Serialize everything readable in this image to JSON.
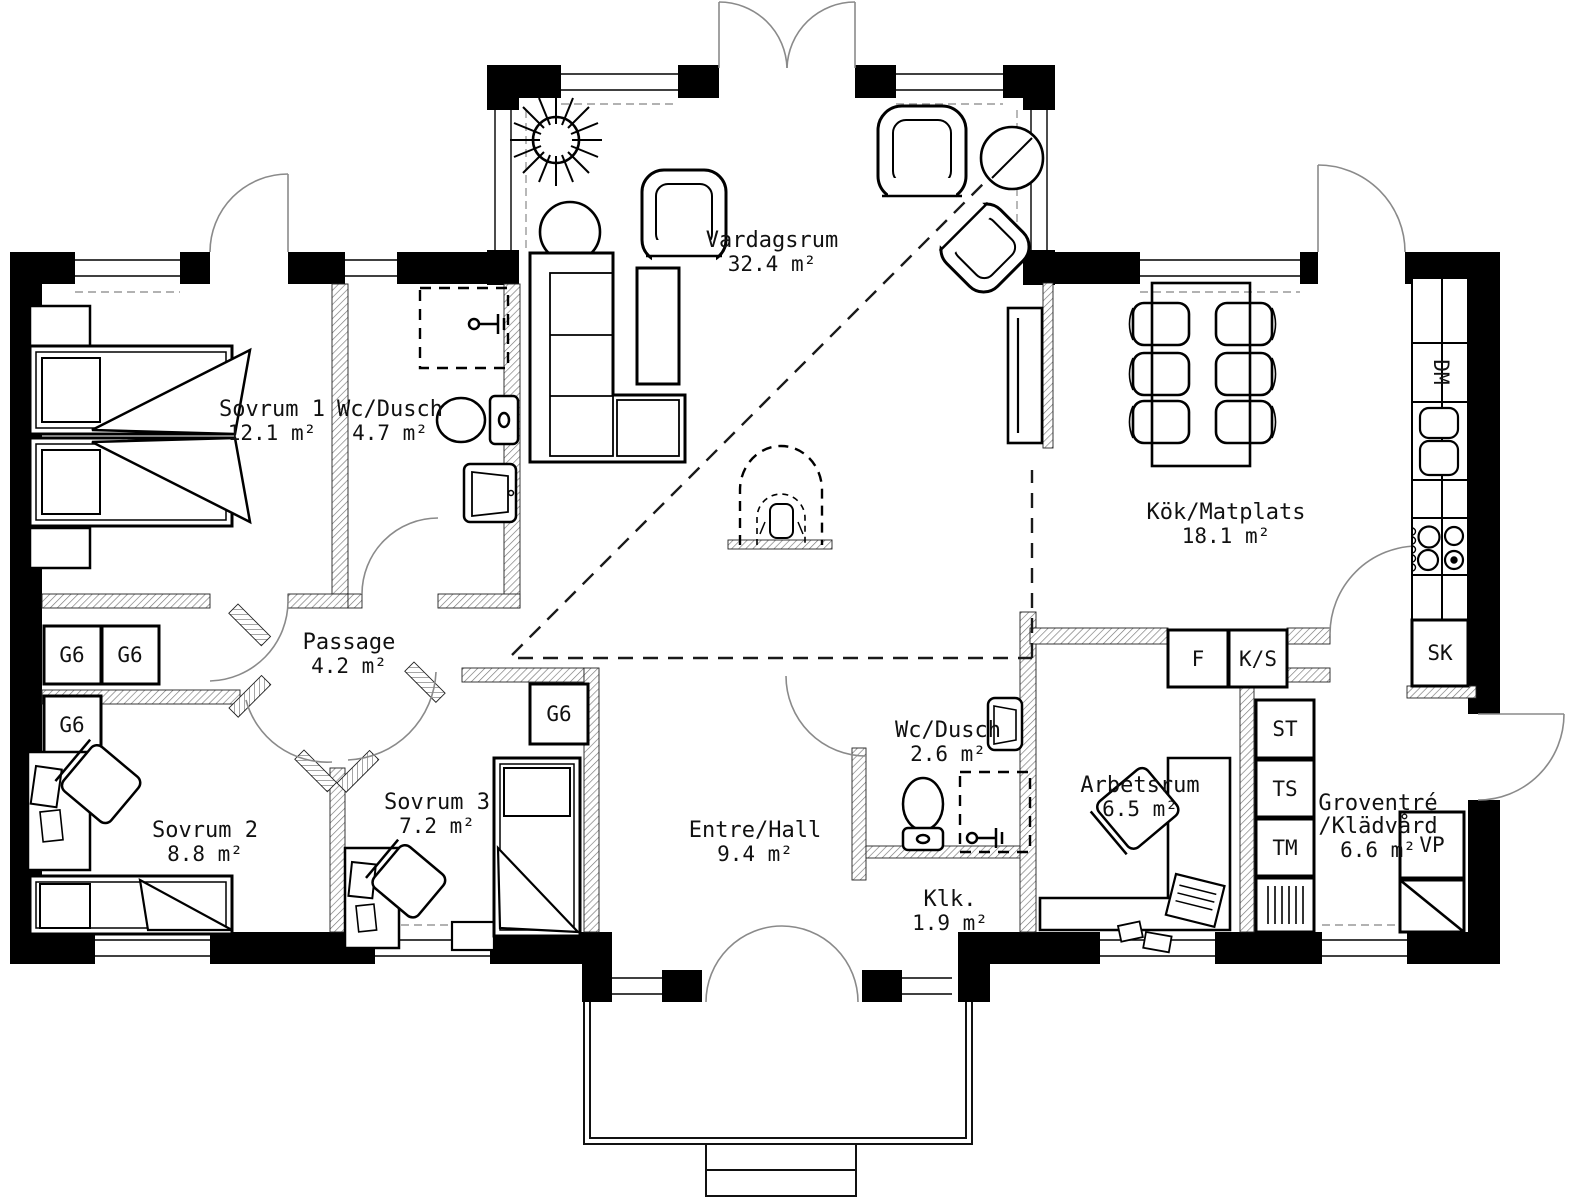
{
  "colors": {
    "wall": "#000000",
    "background": "#ffffff",
    "dashed_line": "#1a1a1a",
    "door_arc": "#8a8a8a"
  },
  "rooms": {
    "sovrum1": {
      "label": "Sovrum 1",
      "area": "12.1 m²"
    },
    "wc_dusch1": {
      "label": "Wc/Dusch",
      "area": "4.7 m²"
    },
    "vardagsrum": {
      "label": "Vardagsrum",
      "area": "32.4 m²"
    },
    "kok_matplats": {
      "label": "Kök/Matplats",
      "area": "18.1 m²"
    },
    "passage": {
      "label": "Passage",
      "area": "4.2 m²"
    },
    "sovrum2": {
      "label": "Sovrum 2",
      "area": "8.8 m²"
    },
    "sovrum3": {
      "label": "Sovrum 3",
      "area": "7.2 m²"
    },
    "entre_hall": {
      "label": "Entre/Hall",
      "area": "9.4 m²"
    },
    "wc_dusch2": {
      "label": "Wc/Dusch",
      "area": "2.6 m²"
    },
    "klk": {
      "label": "Klk.",
      "area": "1.9 m²"
    },
    "arbetsrum": {
      "label": "Arbetsrum",
      "area": "6.5 m²"
    },
    "groventre": {
      "label": "Groventré",
      "label2": "/Klädvård",
      "area": "6.6 m²"
    }
  },
  "fixtures": {
    "g6": "G6",
    "f": "F",
    "ks": "K/S",
    "st": "ST",
    "ts": "TS",
    "tm": "TM",
    "dm": "DM",
    "sk": "SK",
    "vp": "VP"
  }
}
